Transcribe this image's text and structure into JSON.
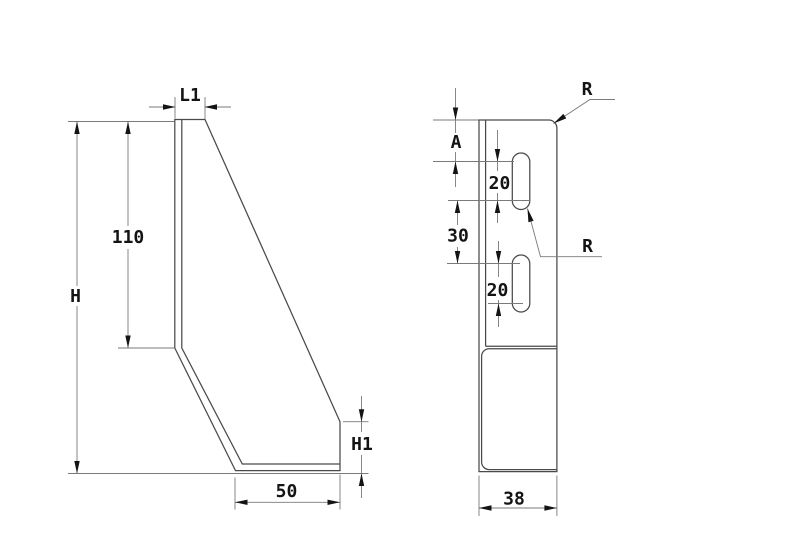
{
  "drawing": {
    "left_view": {
      "flange_width_label": "L1",
      "plate_height_label": "110",
      "total_height_label": "H",
      "base_height_label": "H1",
      "base_length_label": "50"
    },
    "right_view": {
      "top_offset_label": "A",
      "slot1_length_label": "20",
      "slot_spacing_label": "30",
      "slot2_length_label": "20",
      "width_label": "38",
      "corner_radius_label": "R",
      "slot_radius_label": "R"
    },
    "colors": {
      "background": "#ffffff",
      "outline": "#4a4a4a",
      "dimension_lines": "#7a7a7a",
      "text_and_arrows": "#141414"
    }
  }
}
